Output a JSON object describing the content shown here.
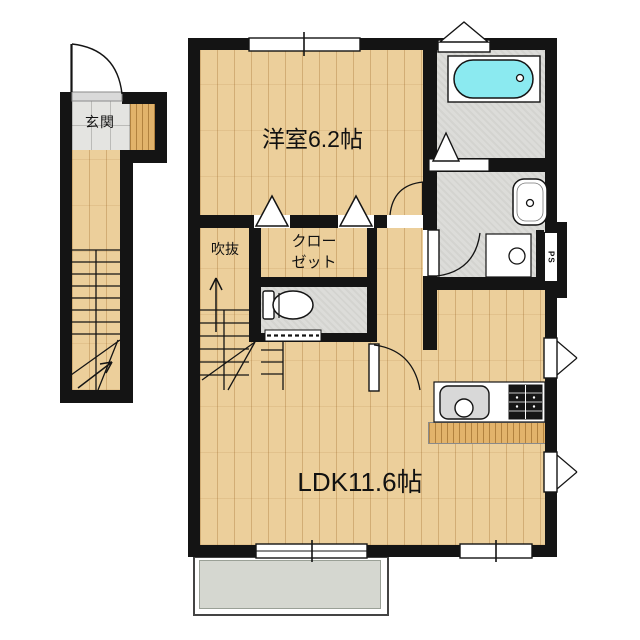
{
  "plan": {
    "type": "floor-plan",
    "rooms": {
      "entrance_label": "玄関",
      "bedroom_label": "洋室6.2帖",
      "void_label": "吹抜",
      "closet_label_line1": "クロー",
      "closet_label_line2": "ゼット",
      "ldk_label": "LDK11.6帖",
      "pipe_space_label": "PS"
    },
    "fixtures": [
      "entrance-door",
      "staircase",
      "bathtub",
      "bath-folding-door",
      "washbasin",
      "washing-machine-pan",
      "toilet",
      "toilet-accordion-door",
      "closet-bifold-doors",
      "bedroom-door",
      "washroom-door",
      "ldk-door",
      "kitchen-sink",
      "gas-stove",
      "sliding-window",
      "casement-window",
      "balcony"
    ],
    "colors": {
      "wall": "#141414",
      "wood": "#eccf9b",
      "tile": "#e4e4e1",
      "wet": "#dcdcd9",
      "tub": "#8beaf0",
      "balcony": "#d5d7d0",
      "sink": "#d8d8d8"
    }
  }
}
